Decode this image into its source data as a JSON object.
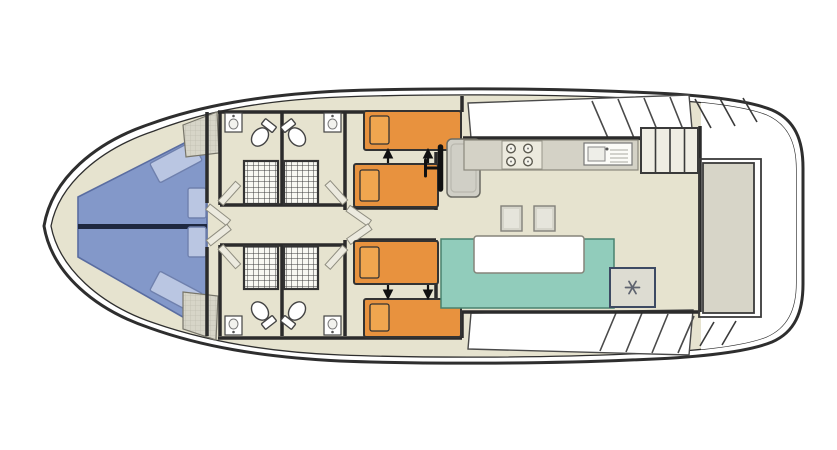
{
  "diagram": {
    "kind": "houseboat-floor-plan-top-view",
    "orientation": "bow-left-stern-right",
    "rooms": [
      "bow-lounge",
      "bathroom",
      "bathroom",
      "bathroom",
      "bathroom",
      "cabin-fore-top",
      "cabin-fore-bottom",
      "wheelhouse",
      "galley",
      "salon",
      "aft-deck"
    ]
  },
  "colors": {
    "hull_line": "#2e2e2e",
    "deck_white": "#ffffff",
    "floor_beige": "#e6e3cf",
    "wall_dark": "#2b2b2b",
    "lounge_blue": "#8398c9",
    "cushion_blue": "#bac6e2",
    "centerline_navy": "#1e2840",
    "bed_orange": "#e8923e",
    "pillow_orange": "#f0a64f",
    "bench_teal": "#91ccbb",
    "counter_gray": "#d4d2c6",
    "seat_gray": "#d0cfc6",
    "stool_gray": "#d6d5cb",
    "fridge_gray": "#dddcd2",
    "fridge_outline": "#3d4a63",
    "steps_fill": "#efede3",
    "wardrobe_gray": "#d7d5c8"
  },
  "fixtures": {
    "bow_cushions": 4,
    "double_bathrooms": 4,
    "toilets": 4,
    "bathroom_sinks": 4,
    "showers": 4,
    "beds": 4,
    "bed_join_arrows": 4,
    "helm": [
      "steering-wheel",
      "helm-seat"
    ],
    "stove_burners": 4,
    "galley_sink": 1,
    "stools": 2,
    "dinette": [
      "u-bench",
      "table"
    ],
    "fridge_icon": "snowflake-icon",
    "steps_treads": 4,
    "aft_bench": 1
  }
}
